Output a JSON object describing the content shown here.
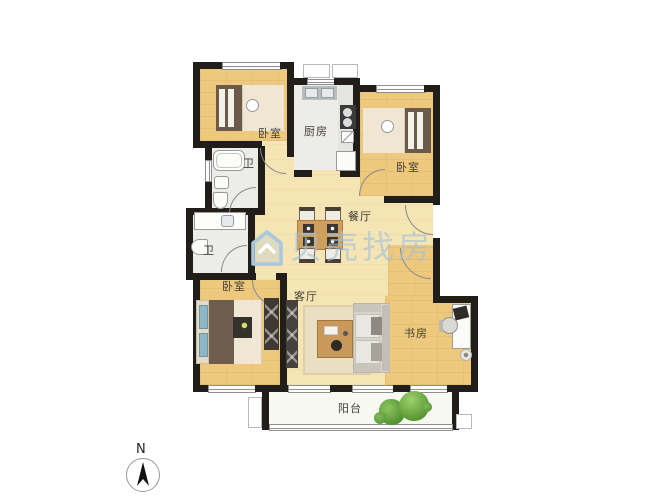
{
  "floorplan": {
    "rooms": {
      "bedroom_top_left": "卧室",
      "kitchen": "厨房",
      "bedroom_top_right": "卧室",
      "bath_upper": "卫",
      "bath_lower": "卫",
      "dining_room": "餐厅",
      "bedroom_bottom_left": "卧室",
      "living_room": "客厅",
      "study": "书房",
      "balcony": "阳台"
    },
    "colors": {
      "wall": "#211e19",
      "wood_floor": "#edc87d",
      "open_area_floor": "#f5e4b4",
      "tile_floor": "#ececE8",
      "balcony_floor": "#f8f8f2",
      "plant_green": "#5c9a37",
      "watermark_blue": "#a9c7df"
    }
  },
  "watermark": {
    "text": "贝壳找房"
  },
  "compass": {
    "north_label": "N"
  }
}
